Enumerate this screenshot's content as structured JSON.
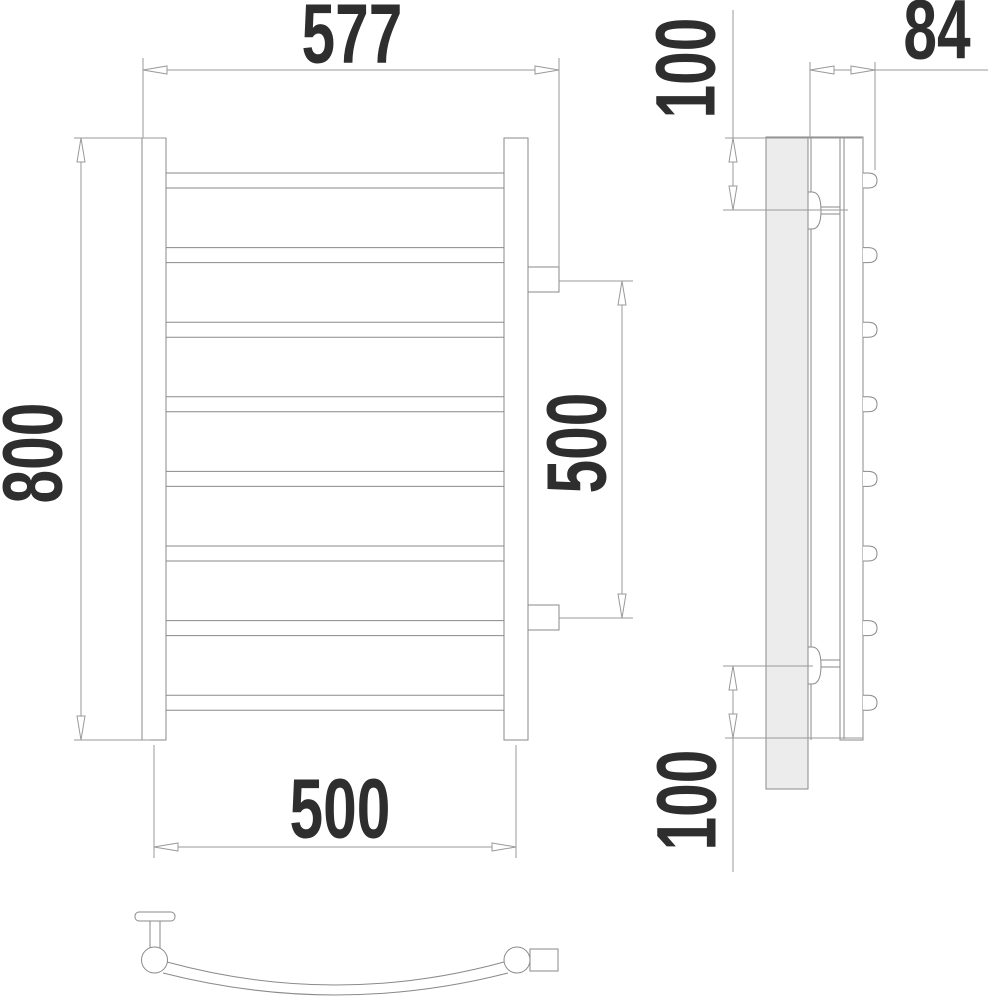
{
  "dimensions": {
    "front_overall_width_mm": "577",
    "front_overall_height_mm": "800",
    "front_bottom_width_mm": "500",
    "front_bracket_spacing_mm": "500",
    "side_depth_mm": "84",
    "side_top_offset_mm": "100",
    "side_bottom_offset_mm": "100"
  },
  "front_view": {
    "bar_count": 8,
    "bar_x": 166,
    "bar_width": 338,
    "first_bar_top_y": 173,
    "bar_spacing": 74.6,
    "bar_height": 15
  },
  "side_view": {
    "bar_end_count": 8,
    "first_bar_end_center_y": 180.5,
    "bar_end_spacing": 74.6
  },
  "colors": {
    "structure_line": "#8a8a8a",
    "dimension_line": "#9a9a9a",
    "text": "#2e2e2e",
    "wall_plate_fill": "#ececec",
    "background": "#ffffff"
  }
}
